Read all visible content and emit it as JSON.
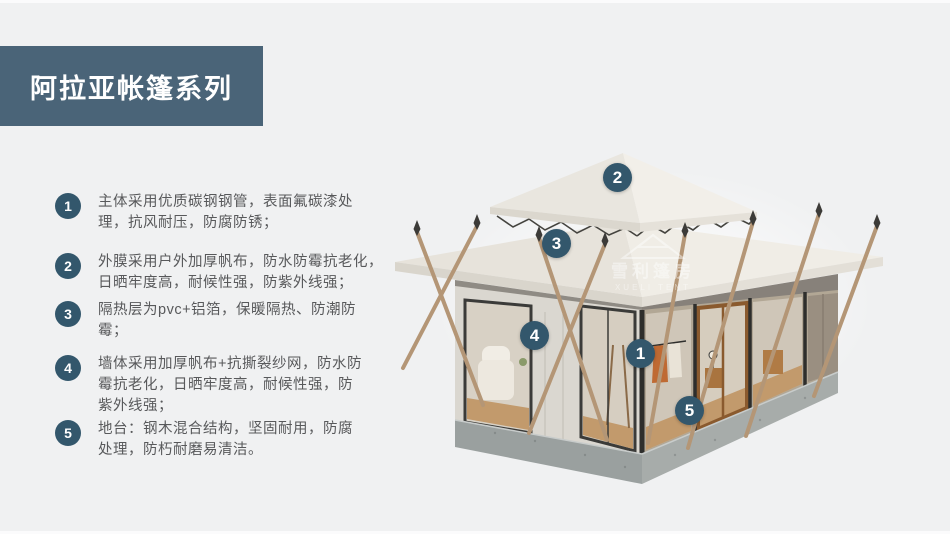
{
  "page": {
    "title": "阿拉亚帐篷系列"
  },
  "colors": {
    "banner": "#4a6478",
    "badge": "#33576c",
    "background": "#f0f1f2",
    "text": "#58595b",
    "roof": "#ece9e2",
    "base_concrete": "#9fa3a1",
    "pole": "#b49676",
    "wood_floor": "#c29a6c"
  },
  "features": [
    {
      "num": "1",
      "text": "主体采用优质碳钢钢管，表面氟碳漆处\n理，抗风耐压，防腐防锈；"
    },
    {
      "num": "2",
      "text": "外膜采用户外加厚帆布，防水防霉抗老化，\n日晒牢度高，耐候性强，防紫外线强；"
    },
    {
      "num": "3",
      "text": "隔热层为pvc+铝箔，保暖隔热、防潮防\n霉；"
    },
    {
      "num": "4",
      "text": "墙体采用加厚帆布+抗撕裂纱网，防水防\n霉抗老化，日晒牢度高，耐候性强，防\n紫外线强；"
    },
    {
      "num": "5",
      "text": "地台：钢木混合结构，坚固耐用，防腐\n处理，防朽耐磨易清洁。"
    }
  ],
  "watermark": {
    "cn": "雪利篷房",
    "en": "XUELI TENT"
  }
}
